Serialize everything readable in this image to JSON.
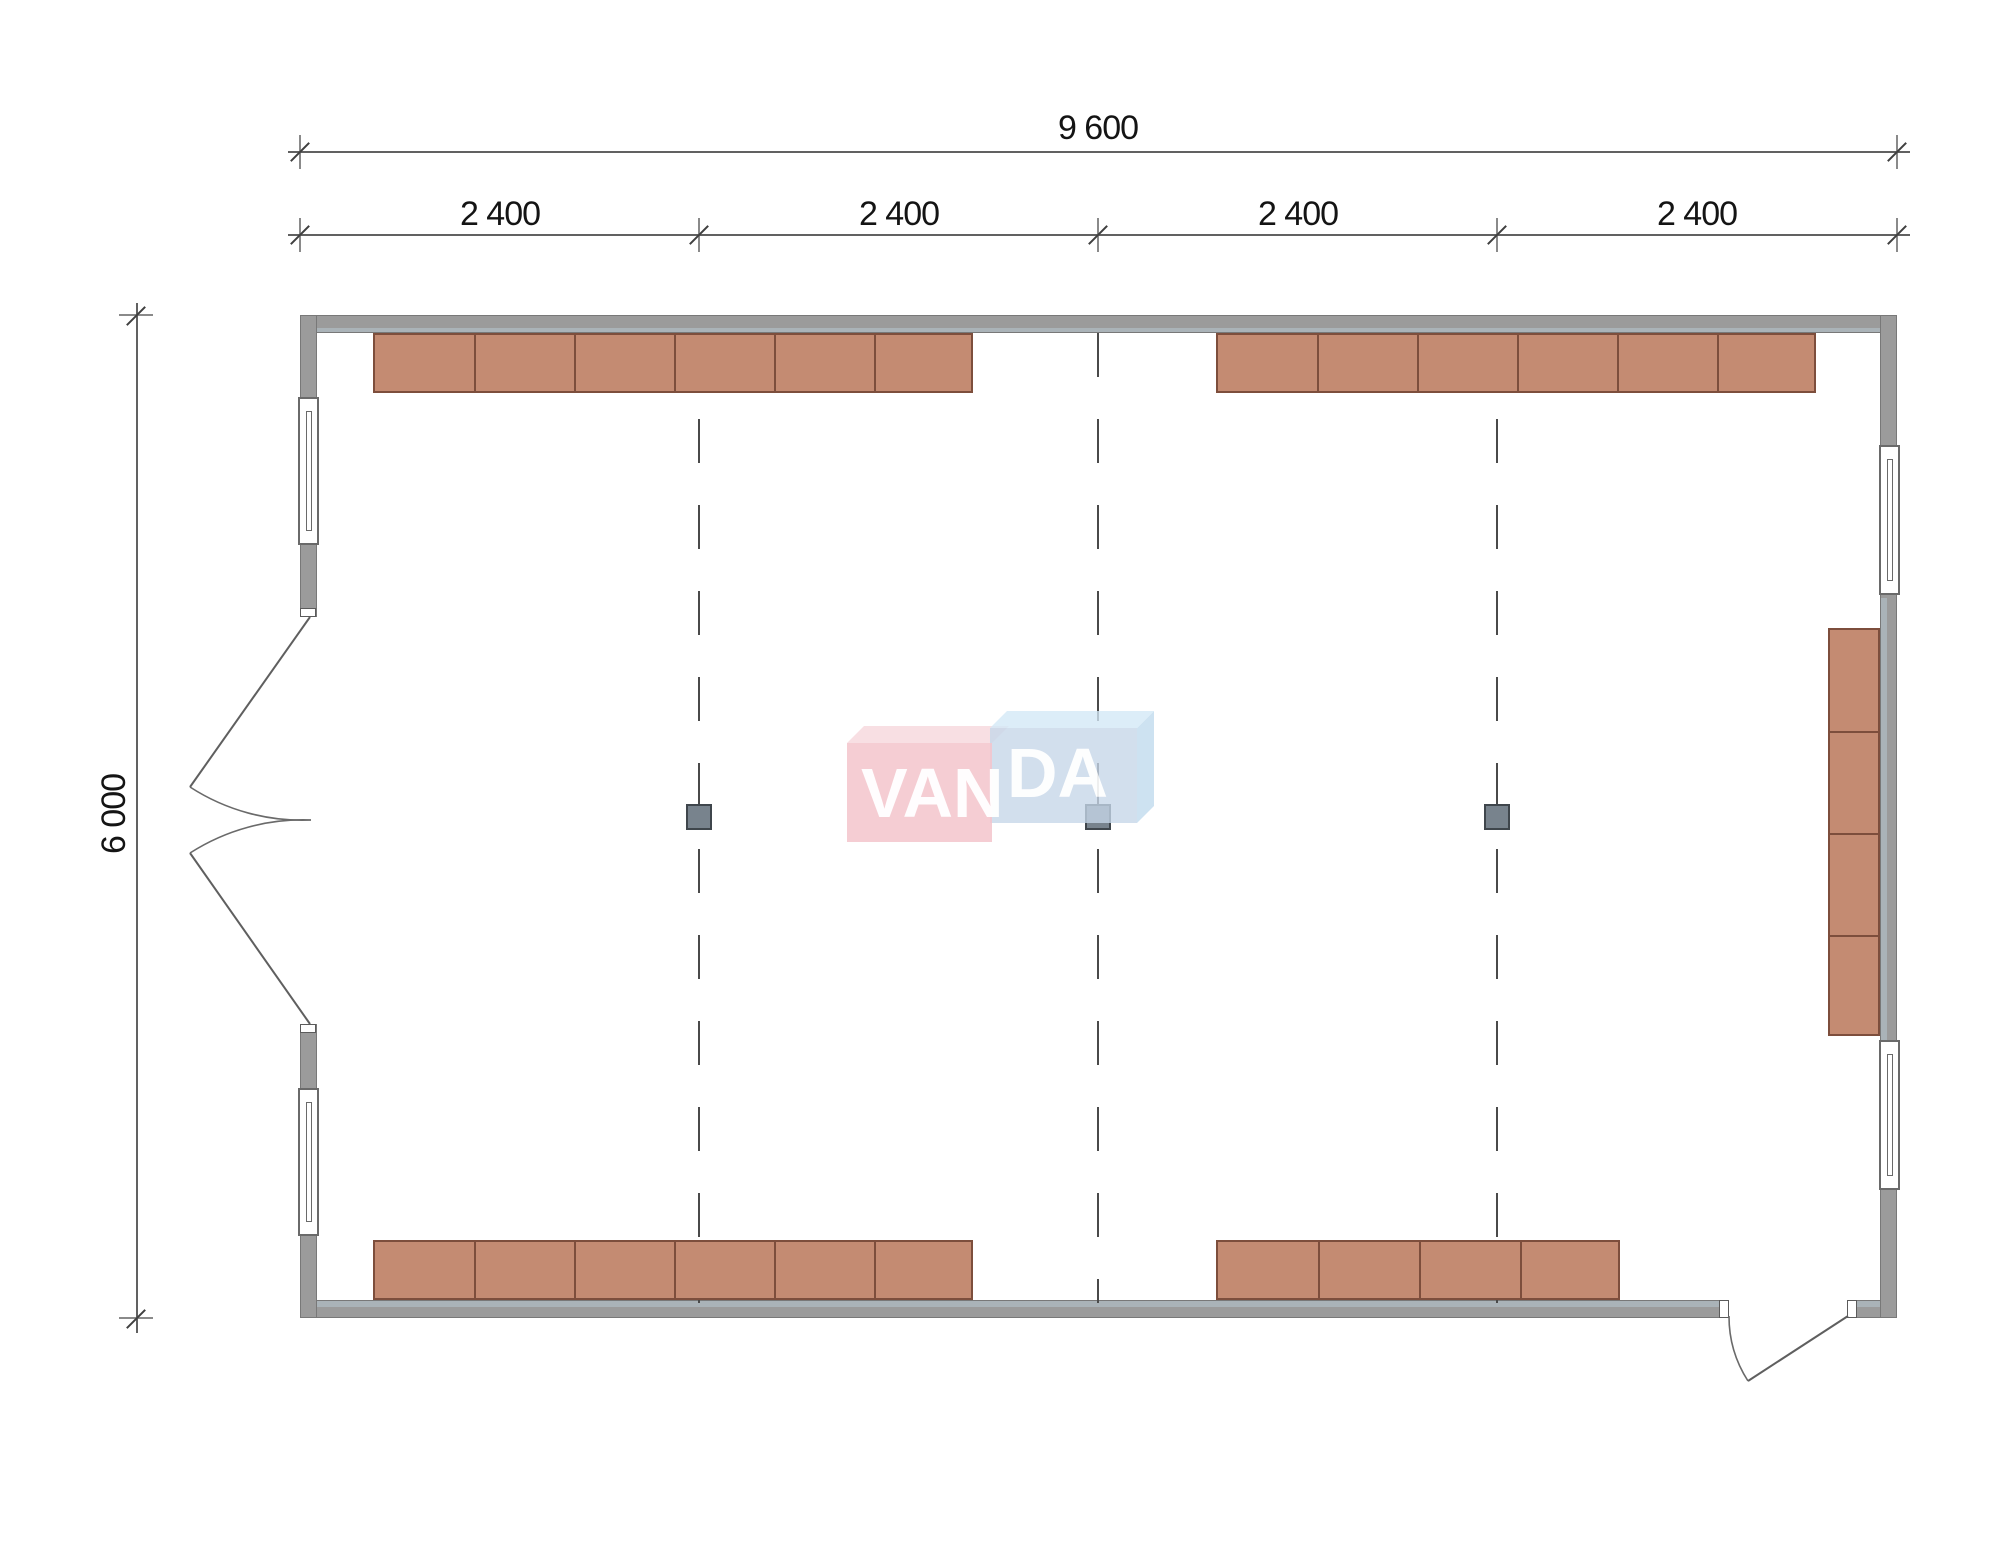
{
  "drawing": {
    "title": "floor-plan",
    "dimensions": {
      "total_width_label": "9 600",
      "bays": [
        "2 400",
        "2 400",
        "2 400",
        "2 400"
      ],
      "total_height_label": "6 000"
    },
    "logo": {
      "brand": "VANDA",
      "left_text": "VAN",
      "right_text": "DA"
    },
    "theme": {
      "wall": "#9b9b9b",
      "wallLiner": "#aab3b8",
      "furn": "#c48b72",
      "furnEdge": "#7d4e3c",
      "line": "#4a4a4a",
      "dimLine": "#616161",
      "text": "#141414",
      "colFill": "#78838d",
      "colEdge": "#3f464c",
      "logoPink": "#f2c2ca",
      "logoBlue": "#c5d6e7"
    },
    "plan": {
      "grid_lines": {
        "xs": [
          699,
          1098,
          1497
        ],
        "y1": 333,
        "y2": 1303
      },
      "columns": [
        {
          "x": 699,
          "y": 817
        },
        {
          "x": 1098,
          "y": 817
        },
        {
          "x": 1497,
          "y": 817
        }
      ],
      "furniture_runs": [
        {
          "x": 373,
          "y": 333,
          "w": 600,
          "h": 60,
          "cols": 6,
          "rows": 1
        },
        {
          "x": 1216,
          "y": 333,
          "w": 600,
          "h": 60,
          "cols": 6,
          "rows": 1
        },
        {
          "x": 373,
          "y": 1240,
          "w": 600,
          "h": 60,
          "cols": 6,
          "rows": 1
        },
        {
          "x": 1216,
          "y": 1240,
          "w": 404,
          "h": 60,
          "cols": 4,
          "rows": 1
        },
        {
          "x": 1828,
          "y": 628,
          "w": 52,
          "h": 408,
          "cols": 1,
          "rows": 4
        }
      ],
      "windows": [
        {
          "x": 298,
          "y": 397,
          "w": 21,
          "h": 148
        },
        {
          "x": 298,
          "y": 1088,
          "w": 21,
          "h": 148
        },
        {
          "x": 1879,
          "y": 445,
          "w": 21,
          "h": 150
        },
        {
          "x": 1879,
          "y": 1040,
          "w": 21,
          "h": 150
        }
      ],
      "dim_ticks_h": [
        {
          "x": 300,
          "y": 151
        },
        {
          "x": 1897,
          "y": 151
        },
        {
          "x": 300,
          "y": 234
        },
        {
          "x": 699,
          "y": 234
        },
        {
          "x": 1098,
          "y": 234
        },
        {
          "x": 1497,
          "y": 234
        },
        {
          "x": 1897,
          "y": 234
        }
      ],
      "dim_ticks_v": [
        {
          "x": 136,
          "y": 315
        },
        {
          "x": 136,
          "y": 1318
        }
      ]
    }
  }
}
